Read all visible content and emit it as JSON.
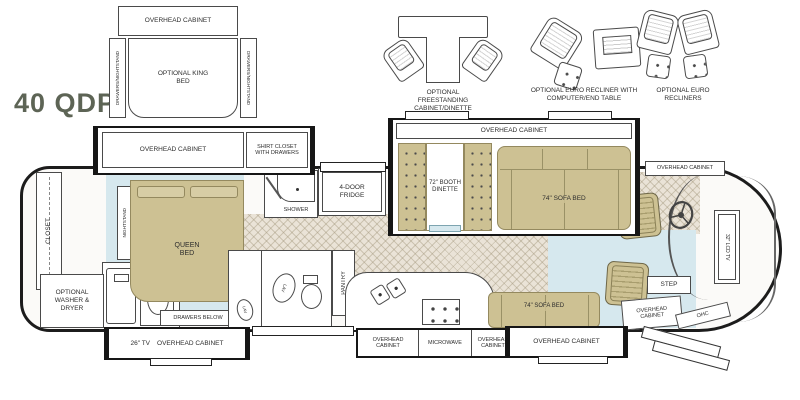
{
  "title": "40 QDP",
  "colors": {
    "furniture_tan": "#cdc193",
    "floor_blue": "#d6e8ee",
    "floor_beige": "#eae3d7",
    "outline_dark": "#1c1c1c",
    "title_green": "#5d6455"
  },
  "options": {
    "king": {
      "overhead": "OVERHEAD CABINET",
      "bed": "OPTIONAL KING BED",
      "left_strip": "DRAWERS/NIGHTSTAND",
      "right_strip": "DRAWERS/NIGHTSTAND"
    },
    "dinette": {
      "caption": "OPTIONAL FREESTANDING CABINET/DINETTE"
    },
    "recliner_table": {
      "caption": "OPTIONAL EURO RECLINER WITH COMPUTER/END TABLE"
    },
    "recliners": {
      "caption": "OPTIONAL EURO RECLINERS"
    }
  },
  "bedroom": {
    "overhead": "OVERHEAD CABINET",
    "shirt_closet": "SHIRT CLOSET WITH DRAWERS",
    "nightstand": "NIGHTSTAND",
    "queen_bed": "QUEEN BED",
    "closet": "CLOSET",
    "washer_dryer": "OPTIONAL WASHER & DRYER",
    "drawers_below": "DRAWERS BELOW",
    "tv": "26\" TV",
    "tv_overhead": "OVERHEAD CABINET"
  },
  "bath": {
    "shower": "SHOWER",
    "lav_a": "LAV",
    "lav_b": "LAV",
    "pantry": "PANTRY"
  },
  "kitchen": {
    "fridge": "4-DOOR FRIDGE",
    "overhead_left": "OVERHEAD CABINET",
    "microwave": "MICROWAVE",
    "overhead_right": "OVERHEAD CABINET"
  },
  "living": {
    "overhead": "OVERHEAD CABINET",
    "booth_dinette": "72\" BOOTH DINETTE",
    "sofa_top": "74\" SOFA BED",
    "sofa_bottom": "74\" SOFA BED",
    "sofa_overhead": "OVERHEAD CABINET"
  },
  "cab": {
    "overhead": "OVERHEAD CABINET",
    "lcd_tv": "32\" LCD TV",
    "step": "STEP",
    "overhead_small": "OVERHEAD CABINET",
    "ohc": "OHC"
  }
}
